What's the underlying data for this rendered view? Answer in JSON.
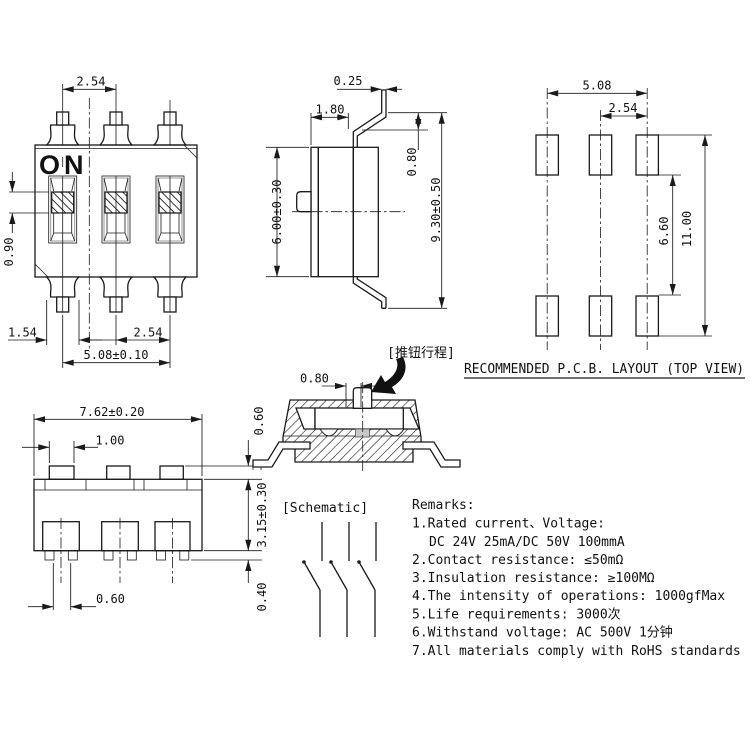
{
  "front_view": {
    "on_label": "ON",
    "dims": {
      "pitch_top": "2.54",
      "knob_height": "0.90",
      "pad_width": "1.54",
      "pitch_bottom": "2.54",
      "span": "5.08±0.10"
    }
  },
  "side_view": {
    "dims": {
      "pin_thickness": "0.25",
      "top_width": "1.80",
      "pin_offset": "0.80",
      "body_height": "6.00±0.30",
      "overall_height": "9.30±0.50"
    }
  },
  "pcb_layout": {
    "title": "RECOMMENDED P.C.B. LAYOUT (TOP VIEW)",
    "dims": {
      "span": "5.08",
      "pitch": "2.54",
      "inner_gap": "6.60",
      "overall": "11.00"
    }
  },
  "bottom_view": {
    "dims": {
      "body_width": "7.62±0.20",
      "bump_width": "1.00",
      "bump_height": "0.60",
      "body_thickness": "3.15±0.30",
      "foot_height": "0.40",
      "foot_width": "0.60"
    }
  },
  "section_view": {
    "travel_label": "[推钮行程]",
    "dims": {
      "travel": "0.80"
    }
  },
  "schematic": {
    "label": "[Schematic]"
  },
  "remarks": {
    "title": "Remarks:",
    "lines": [
      "1.Rated current、Voltage:",
      "DC 24V 25mA/DC 50V 100mmA",
      "2.Contact resistance: ≤50mΩ",
      "3.Insulation resistance: ≥100MΩ",
      "4.The intensity of operations: 1000gfMax",
      "5.Life requirements: 3000次",
      "6.Withstand voltage: AC 500V 1分钟",
      "7.All materials comply with RoHS standards"
    ]
  }
}
